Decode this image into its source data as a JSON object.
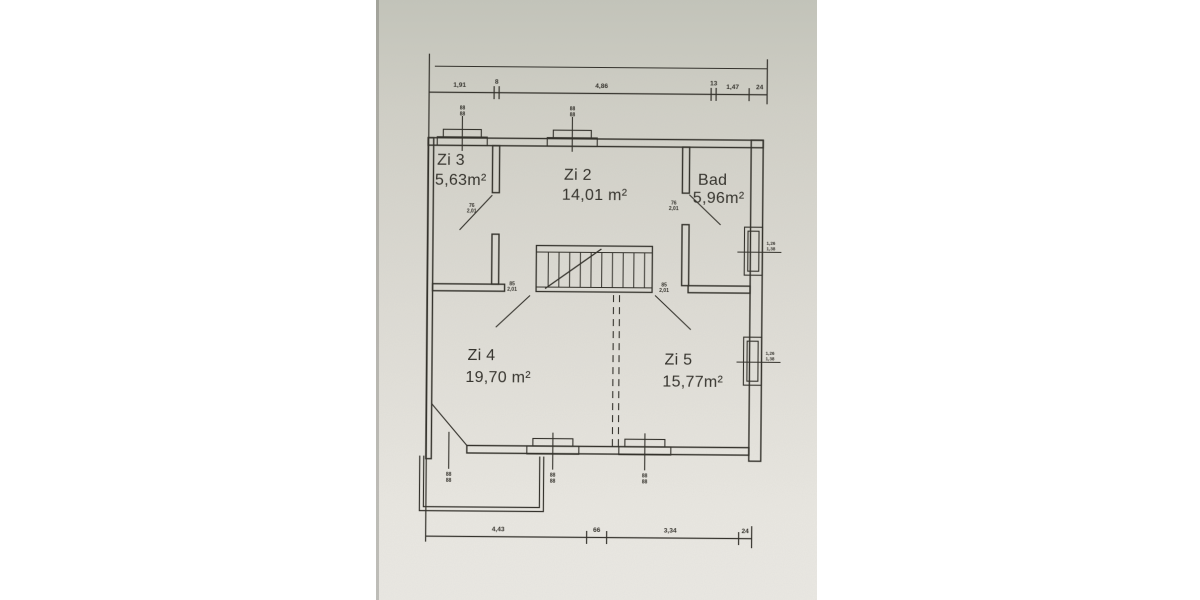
{
  "document": {
    "type": "floor-plan-scan",
    "paper_color": "#dddbd4",
    "ink_color": "#34322c",
    "background_color": "#ffffff"
  },
  "rooms": [
    {
      "id": "zi3",
      "name": "Zi 3",
      "area": "5,63m²"
    },
    {
      "id": "zi2",
      "name": "Zi 2",
      "area": "14,01 m²"
    },
    {
      "id": "bad",
      "name": "Bad",
      "area": "5,96m²"
    },
    {
      "id": "zi4",
      "name": "Zi 4",
      "area": "19,70 m²"
    },
    {
      "id": "zi5",
      "name": "Zi 5",
      "area": "15,77m²"
    }
  ],
  "dimensions": {
    "top": [
      "1,91",
      "8",
      "4,86",
      "13",
      "1,47",
      "24"
    ],
    "bottom": [
      "4,43",
      "66",
      "3,34",
      "24"
    ]
  },
  "doors": [
    {
      "room": "zi3",
      "width": "76",
      "height": "2,01"
    },
    {
      "room": "bad",
      "width": "76",
      "height": "2,01"
    },
    {
      "room": "zi4",
      "width": "85",
      "height": "2,01"
    },
    {
      "room": "zi5",
      "width": "85",
      "height": "2,01"
    }
  ],
  "windows": {
    "top": [
      {
        "l1": "88",
        "l2": "88"
      },
      {
        "l1": "88",
        "l2": "88"
      }
    ],
    "right": [
      {
        "l1": "1,26",
        "l2": "1,38"
      },
      {
        "l1": "1,26",
        "l2": "1,38"
      }
    ],
    "bottom": [
      {
        "l1": "88",
        "l2": "88"
      },
      {
        "l1": "88",
        "l2": "88"
      },
      {
        "l1": "88",
        "l2": "88"
      }
    ]
  }
}
